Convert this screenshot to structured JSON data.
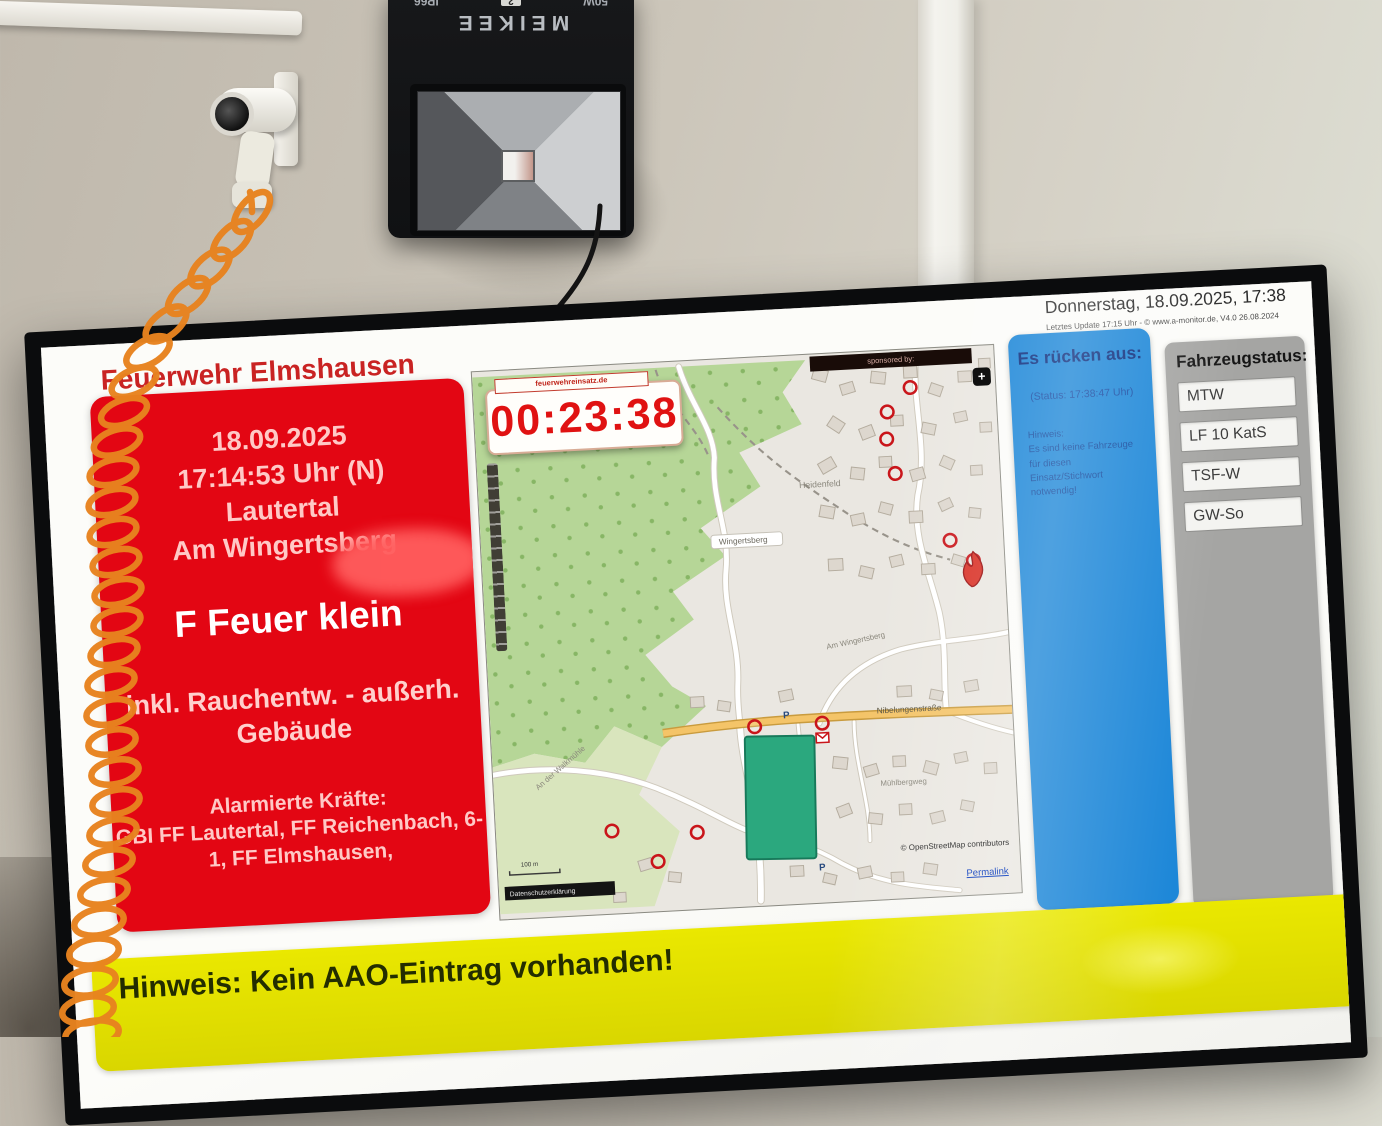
{
  "scene": {
    "floodlight": {
      "brand": "MEIKEE",
      "power": "50W",
      "ip_rating": "IP66",
      "tag": "2"
    }
  },
  "screen": {
    "title": "Feuerwehr Elmshausen",
    "datetime": "Donnerstag, 18.09.2025, 17:38",
    "update_note": "Letztes Update 17:15 Uhr - © www.a-monitor.de, V4.0 26.08.2024",
    "alarm": {
      "date": "18.09.2025",
      "time": "17:14:53 Uhr (N)",
      "city": "Lautertal",
      "street": "Am Wingertsberg",
      "keyword": "F Feuer klein",
      "details_line1": "inkl. Rauchentw. - außerh.",
      "details_line2": "Gebäude",
      "forces_label": "Alarmierte Kräfte:",
      "forces_line1": "GBI FF Lautertal, FF Reichenbach, 6-",
      "forces_line2": "1, FF Elmshausen,"
    },
    "map": {
      "timer": "00:23:38",
      "timer_caption": "feuerwehreinsatz.de",
      "sponsor": "sponsored by:",
      "expand_button": "+",
      "labels": {
        "area": "Heidenfeld",
        "place": "Wingertsberg",
        "street_am_wingertsberg": "Am Wingertsberg",
        "street_nibelungen": "Nibelungenstraße",
        "street_muehlberg": "Mühlbergweg",
        "street_walkmuehle": "An der Walkmühle",
        "parking": "P"
      },
      "scale_label": "100 m",
      "privacy_link": "Datenschutzerklärung",
      "attribution": "© OpenStreetMap contributors",
      "permalink": "Permalink"
    },
    "dispatch": {
      "title": "Es rücken aus:",
      "status": "(Status: 17:38:47 Uhr)",
      "hint_label": "Hinweis:",
      "hint_text": "Es sind keine Fahrzeuge für diesen Einsatz/Stichwort notwendig!"
    },
    "vehicles": {
      "title": "Fahrzeugstatus:",
      "items": [
        "MTW",
        "LF 10 KatS",
        "TSF-W",
        "GW-So"
      ]
    },
    "banner": {
      "text": "Hinweis: Kein AAO-Eintrag vorhanden!"
    }
  },
  "colors": {
    "alarm_red": "#e30613",
    "info_blue": "#1d87d8",
    "panel_gray": "#a5a5a3",
    "banner_yellow": "#e4e400",
    "header_red": "#c92323",
    "timer_red": "#e01212"
  }
}
